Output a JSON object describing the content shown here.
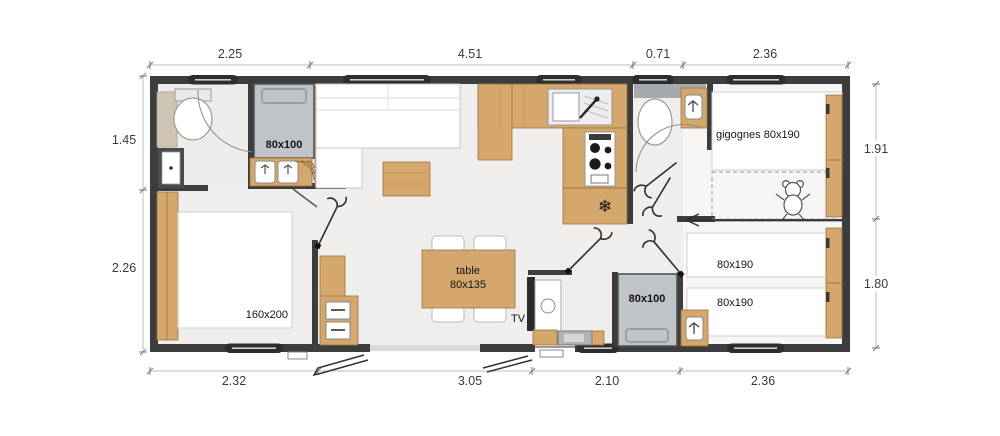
{
  "plan": {
    "type": "mobile-home floor plan",
    "labels": {
      "bed_small_top": "80x100",
      "bed_small_bottom": "80x100",
      "bed_gigognes": "gigognes 80x190",
      "bed_twin_1": "80x190",
      "bed_twin_2": "80x190",
      "bed_master": "160x200",
      "table_line1": "table",
      "table_line2": "80x135",
      "tv": "TV"
    },
    "icons": {
      "fridge_snowflake": "❄"
    },
    "colors": {
      "wall": "#3d3d3d",
      "wood": "#d4a76d",
      "bed_gray": "#c0c3c7",
      "floor": "#efeeec",
      "glass_bay": "#d9d9d9",
      "dimension_text": "#3a3a3a"
    }
  },
  "dimensions": {
    "top": [
      "2.25",
      "4.51",
      "0.71",
      "2.36"
    ],
    "bottom": [
      "2.32",
      "3.05",
      "2.10",
      "2.36"
    ],
    "left": [
      "1.45",
      "2.26"
    ],
    "right": [
      "1.91",
      "1.80"
    ]
  }
}
